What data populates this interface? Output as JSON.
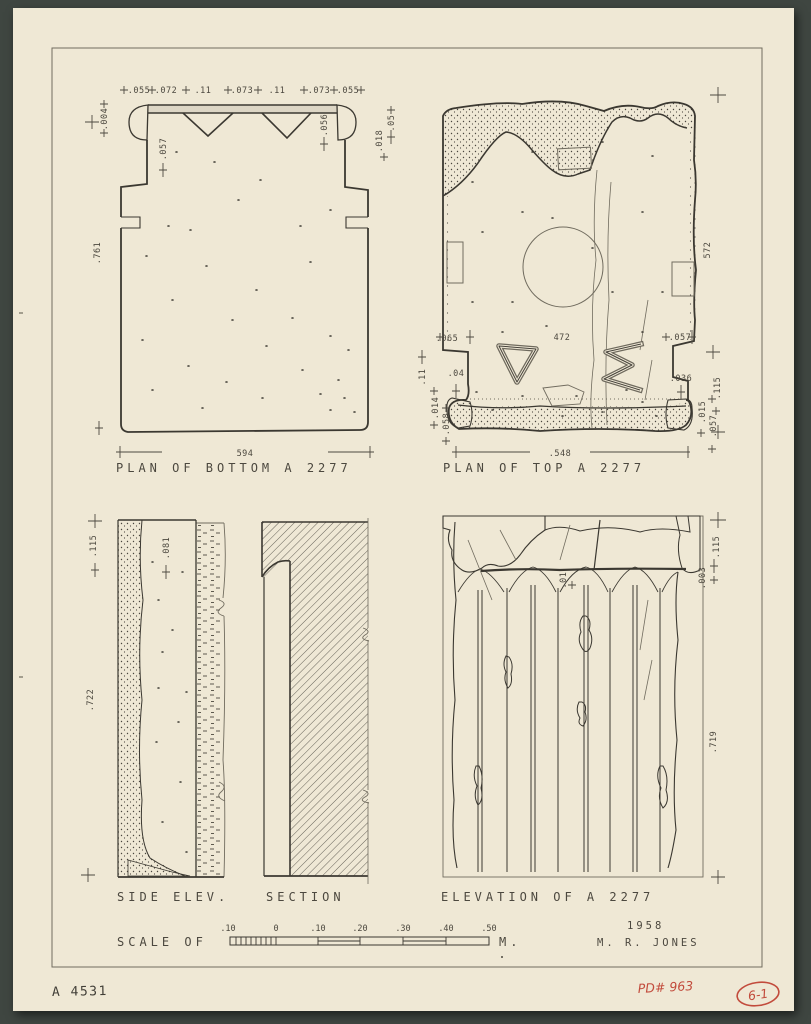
{
  "sheet": {
    "catalog_number": "A 4531",
    "pd_number": "PD# 963",
    "plate_number": "6-1",
    "year": "1958",
    "author": "M. R. JONES"
  },
  "colors": {
    "mat_background": "#3f4641",
    "paper": "#efe8d5",
    "ink": "#3b3831",
    "red_stamp": "#c24b3c"
  },
  "titles": {
    "plan_bottom": "PLAN OF BOTTOM A 2277",
    "plan_top": "PLAN OF TOP A 2277",
    "side_elev": "SIDE ELEV.",
    "section": "SECTION",
    "elevation": "ELEVATION OF A 2277"
  },
  "scale_bar": {
    "prefix": "SCALE OF",
    "unit": "M.",
    "ticks": [
      ".10",
      "0",
      ".10",
      ".20",
      ".30",
      ".40",
      ".50"
    ]
  },
  "dims": {
    "plan_bottom": {
      "top": [
        ".055",
        ".072",
        ".11",
        ".073",
        ".11",
        ".073",
        ".055"
      ],
      "left_edge": ".004",
      "left_inner": ".057",
      "height": ".761",
      "right_inner": ".056",
      "right_edge": ".05",
      "right_lower": ".018",
      "width": "594"
    },
    "plan_top": {
      "step_left": ".065",
      "center": "472",
      "step_right": ".057",
      "left": ".04",
      "right": ".036",
      "left_edge": ".11",
      "left_lower": ".014",
      "left_corner": ".058",
      "right_edge": ".115",
      "right_lower": ".015",
      "right_corner": ".057",
      "height": "572",
      "width": ".548"
    },
    "side_elev": {
      "top": ".115",
      "inner": ".081",
      "height": ".722"
    },
    "elevation": {
      "top": ".115",
      "edge": ".003",
      "inner": ".01",
      "height": ".719"
    }
  }
}
